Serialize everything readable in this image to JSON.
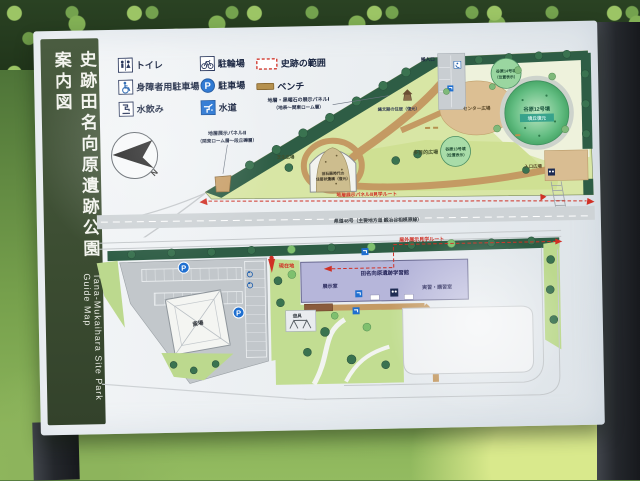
{
  "sign": {
    "title_jp": "史跡田名向原遺跡公園案内図",
    "title_en": "Tana-Mukaihara Site Park Guide Map"
  },
  "legend": {
    "toilet": "トイレ",
    "bicycle_parking": "駐輪場",
    "site_area": "史跡の範囲",
    "accessible_parking": "身障者用駐車場",
    "parking": "駐車場",
    "bench": "ベンチ",
    "drinking_water": "水飲み",
    "water": "水道",
    "p_symbol": "P"
  },
  "upper_map": {
    "panel1_line1": "地層・黒曜石の展示パネルⅠ",
    "panel1_line2": "（地表〜関東ローム層）",
    "panel2_line1": "地層展示パネルⅡ",
    "panel2_line2": "（関東ローム層〜段丘礫層）",
    "jomon_house": "縄文期の住居（復元）",
    "pit_line1": "旧石器時代の",
    "pit_line2": "住居状遺構（復元）",
    "lawn_plaza": "芝生広場",
    "center_plaza": "センター広場",
    "multi_plaza": "多目的広場",
    "mound12": "谷原12号墳",
    "mound12_note": "墳丘復元",
    "mound13_line1": "谷原13号墳",
    "mound13_line2": "（位置表示）",
    "mound14_line1": "谷原14号墳",
    "mound14_line2": "（位置表示）",
    "service_entrance": "搬入口",
    "entrance_plaza": "入口広場",
    "route_label": "地層展示パネルⅡ見学ルート",
    "road_label": "県道48号（主要地方道 鍛冶谷相模原線）",
    "compass_n": "N"
  },
  "lower_map": {
    "route_label": "屋外展示見学ルート",
    "you_are_here": "現在地",
    "learning_center": "田名向原遺跡学習館",
    "exhibit_room": "展示室",
    "training_room": "実習・講習室",
    "funeral_hall": "斎場",
    "playground": "遊具"
  },
  "colors": {
    "board_green": "#3b4c31",
    "route_red": "#d03025",
    "park_green": "#d8e6a5",
    "tree_green": "#2e5d45",
    "path_tan": "#c49a63",
    "building_lavender": "#b6b6da",
    "parking_blue": "#1f6fd0"
  }
}
